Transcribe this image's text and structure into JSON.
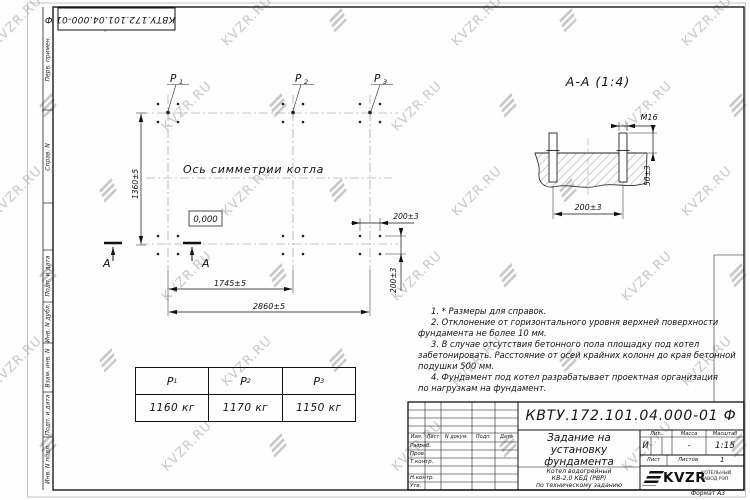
{
  "watermark": {
    "text": "KVZR.RU"
  },
  "frame": {
    "top_stamp": "КВТУ.172.101.04.000-01 Ф",
    "margin_labels": [
      "Перв. примен.",
      "Справ. N",
      "Подп. и дата",
      "Инв. N дубл.",
      "Взам. инв. N",
      "Подп. и дата",
      "Инв. N подл."
    ],
    "format_note": "Формат А3"
  },
  "plan": {
    "p_labels": [
      {
        "name": "P",
        "sub": "1"
      },
      {
        "name": "P",
        "sub": "2"
      },
      {
        "name": "P",
        "sub": "3"
      }
    ],
    "axis_label": "Ось симметрии котла",
    "elevation": "0,000",
    "dim_height": "1360±5",
    "dim_width_inner": "1745±5",
    "dim_width_outer": "2860±5",
    "dim_bolt_x": "200±3",
    "dim_bolt_y": "200±3",
    "section_letter_left": "А",
    "section_letter_right": "А"
  },
  "section": {
    "title": "А-А (1:4)",
    "thread": "М16",
    "dim_protrusion": "50±3",
    "dim_spacing": "200±3"
  },
  "notes": {
    "lines": [
      "1. * Размеры для справок.",
      "2. Отклонение от горизонтального уровня верхней поверхности",
      "фундамента не более 10 мм.",
      "3. В случае отсутствия бетонного пола площадку под котел",
      "забетонировать. Расстояние от осей крайних колонн до края бетонной",
      "подушки 500 мм.",
      "4. Фундамент под котел разрабатывает проектная организация",
      "по нагрузкам на фундамент."
    ]
  },
  "load_table": {
    "headers": [
      {
        "name": "P",
        "sub": "1"
      },
      {
        "name": "P",
        "sub": "2"
      },
      {
        "name": "P",
        "sub": "3"
      }
    ],
    "values": [
      "1160 кг",
      "1170 кг",
      "1150 кг"
    ]
  },
  "title_block": {
    "doc_number": "КВТУ.172.101.04.000-01 Ф",
    "title_line1": "Задание на",
    "title_line2": "установку",
    "title_line3": "фундамента",
    "product_line1": "Котел водогрейный",
    "product_line2": "КВ-2,0 КБД (РВР)",
    "product_line3": "по техническому заданию",
    "cols": [
      "Изм.",
      "Лист",
      "N докум.",
      "Подп.",
      "Дата"
    ],
    "rows": [
      "Разраб.",
      "Пров.",
      "Т.контр.",
      "Н.контр.",
      "Утв."
    ],
    "lit_label": "Лит.",
    "lit_value": "И",
    "mass_label": "Масса",
    "mass_value": "-",
    "scale_label": "Масштаб",
    "scale_value": "1:15",
    "sheet_label": "Лист",
    "sheets_label": "Листов",
    "sheets_value": "1",
    "company": "KVZR",
    "company_sub1": "КОТЕЛЬНЫЙ",
    "company_sub2": "ЗАВОД РЭП"
  }
}
